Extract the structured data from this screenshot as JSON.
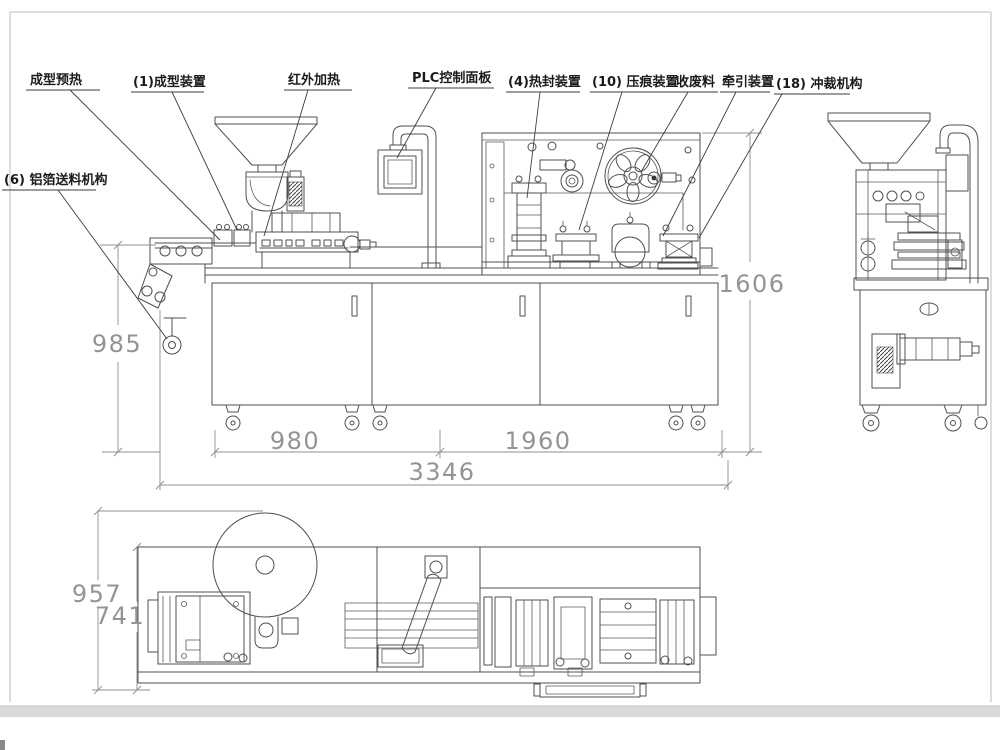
{
  "drawing": {
    "callouts": {
      "forming_preheat": "成型预热",
      "forming_device": "(1)成型装置",
      "infrared_heating": "红外加热",
      "plc_panel": "PLC控制面板",
      "heat_seal": "(4)热封装置",
      "indent_device": "(10) 压痕装置",
      "waste_collect": "收废料",
      "traction_device": "牵引装置",
      "punching_mech": "(18) 冲裁机构",
      "foil_feed": "(6) 铝箔送料机构"
    },
    "dimensions": {
      "front_height": "985",
      "right_height": "1606",
      "front_left_len": "980",
      "front_right_len": "1960",
      "total_len": "3346",
      "plan_width_total": "957",
      "plan_width_body": "741"
    }
  }
}
